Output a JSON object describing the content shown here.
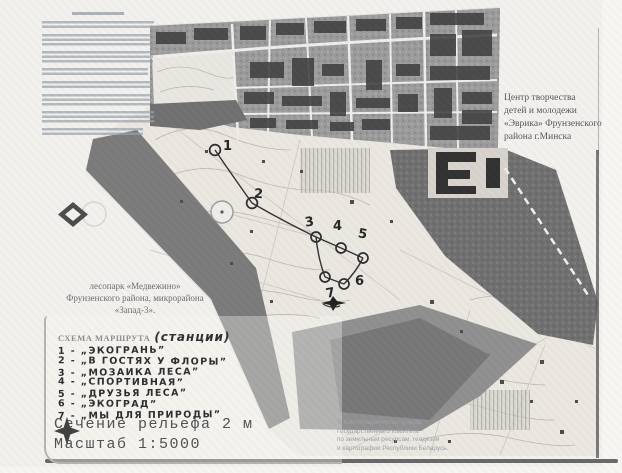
{
  "texts": {
    "organization": {
      "lines": [
        "Центр творчества",
        "детей и молодежи",
        "«Эврика» Фрунзенского",
        "района г.Минска"
      ]
    },
    "park": {
      "lines": [
        "лесопарк «Медвежино»",
        "Фрунзенского района, микрорайона",
        "«Запад-3»."
      ]
    }
  },
  "route_scheme": {
    "title_printed": "СХЕМА МАРШРУТА",
    "title_hand": "(станции)",
    "stations": [
      "1 - „ЭКОГРАНЬ”",
      "2 - „В ГОСТЯХ У ФЛОРЫ”",
      "3 - „МОЗАИКА ЛЕСА”",
      "4 - „СПОРТИВНАЯ”",
      "5 - „ДРУЗЬЯ ЛЕСА”",
      "6 - „ЭКОГРАД”",
      "7 - „МЫ ДЛЯ ПРИРОДЫ”"
    ]
  },
  "route_points": [
    {
      "label": "1"
    },
    {
      "label": "2"
    },
    {
      "label": "3"
    },
    {
      "label": "4"
    },
    {
      "label": "5"
    },
    {
      "label": "6"
    },
    {
      "label": "7"
    }
  ],
  "legend": {
    "contour_text": "Сечение рельефа 2 м",
    "scale_text": "Масштаб 1:5000"
  },
  "copyright": {
    "lines": [
      "© Картографическая основа",
      "Государственного комитета",
      "по земельным ресурсам, геодезии",
      "и картографии Республики Беларусь."
    ]
  },
  "colors": {
    "paper": "#f3f1ed",
    "map_urban": "#9a9a9a",
    "map_dark": "#6f6f6f",
    "buildings": "#3a3a3a",
    "ink_hand": "#2b2b2e",
    "legend_text": "#4f4f52"
  }
}
